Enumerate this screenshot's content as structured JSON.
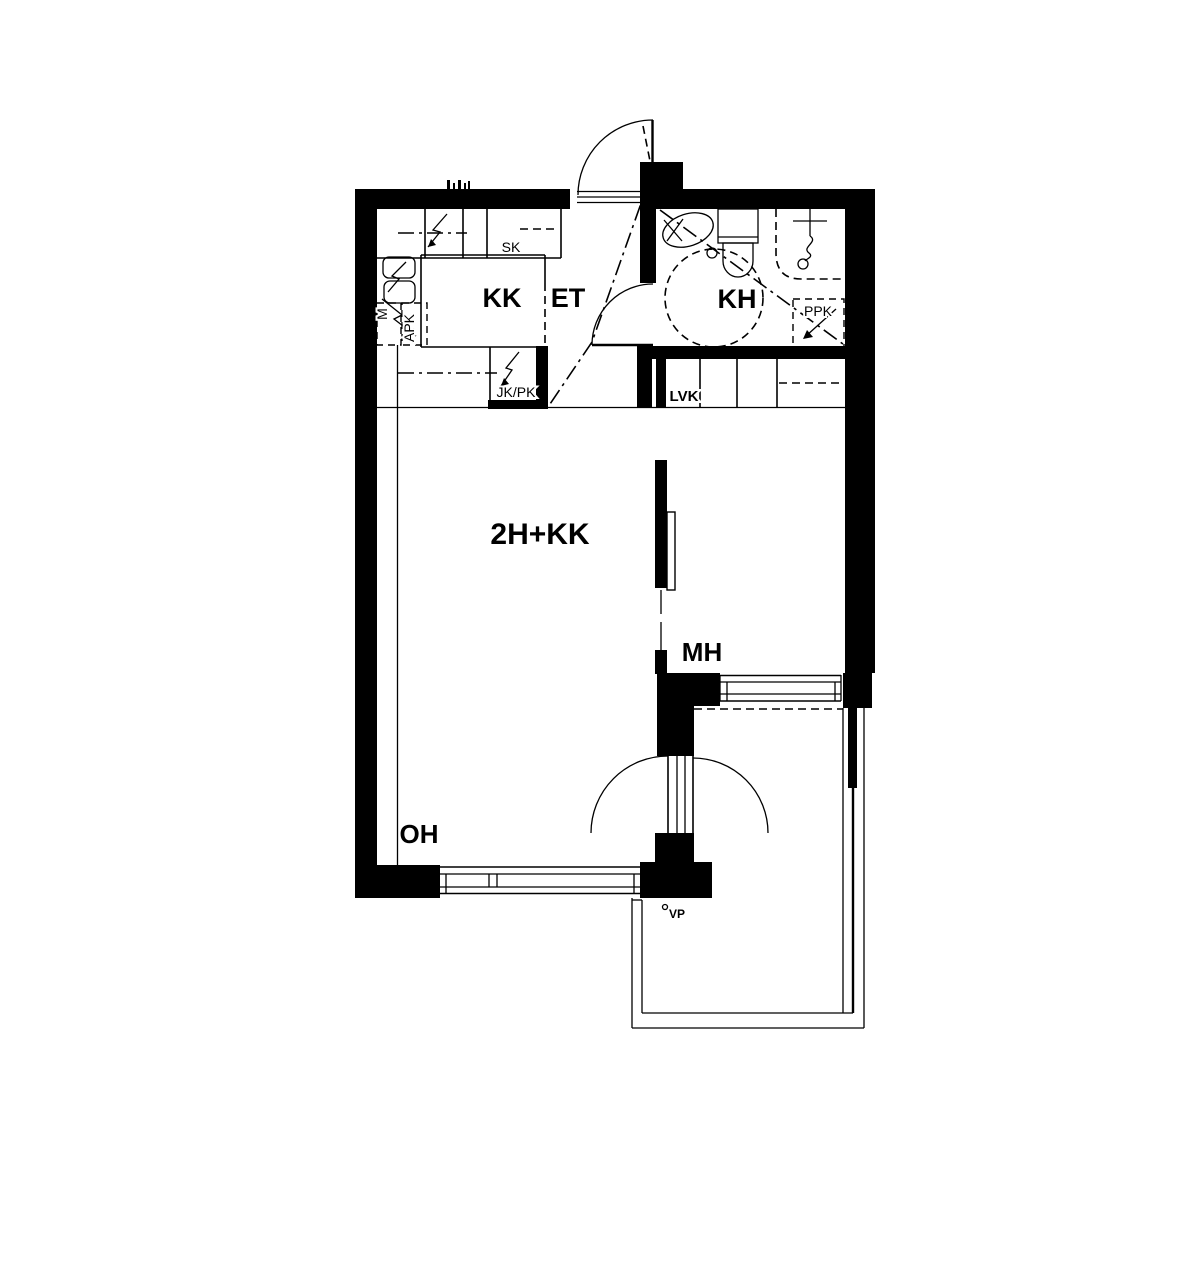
{
  "floor_plan": {
    "apartment_type": "2H+KK",
    "rooms": {
      "kitchenette": "KK",
      "entry": "ET",
      "bathroom": "KH",
      "bedroom": "MH",
      "living_room": "OH"
    },
    "fixtures": {
      "cabinet": "SK",
      "fridge_freezer": "JK/PK",
      "dishwasher": "APK",
      "microwave": "M",
      "linen_closet": "LVK",
      "washer_reservation": "PPK",
      "balcony_mark": "VP"
    },
    "colors": {
      "line": "#000000",
      "background": "#ffffff"
    }
  }
}
